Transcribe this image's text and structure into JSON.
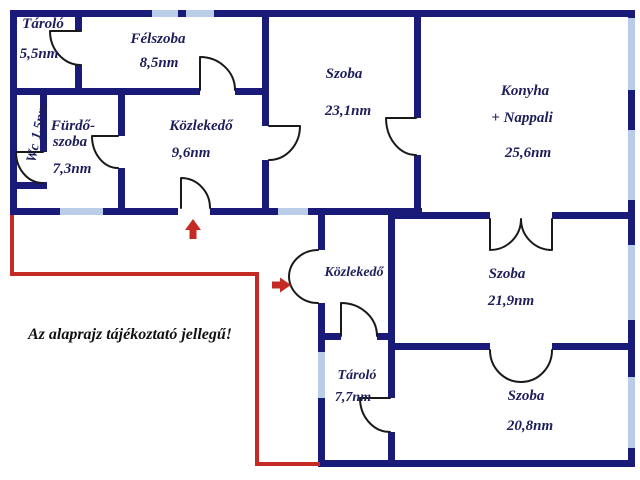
{
  "title": "Floor plan",
  "disclaimer": "Az alaprajz tájékoztató jellegű!",
  "colors": {
    "wall": "#1a1a78",
    "window": "#b9cde8",
    "door": "#1a1a1a",
    "red": "#c32b24",
    "label": "#1e1e5a",
    "ink": "#111111",
    "background": "#ffffff"
  },
  "rooms": [
    {
      "id": "tarolo-1",
      "name": "Tároló",
      "area": "5,5nm"
    },
    {
      "id": "felszoba",
      "name": "Félszoba",
      "area": "8,5nm"
    },
    {
      "id": "wc",
      "name": "Wc",
      "area": "1,5nm"
    },
    {
      "id": "furdoszoba",
      "name_line1": "Fürdő-",
      "name_line2": "szoba",
      "area": "7,3nm"
    },
    {
      "id": "kozlekedo-1",
      "name": "Közlekedő",
      "area": "9,6nm"
    },
    {
      "id": "szoba-1",
      "name": "Szoba",
      "area": "23,1nm"
    },
    {
      "id": "konyha-nappali",
      "name": "Konyha",
      "name_line2": "+ Nappali",
      "area": "25,6nm"
    },
    {
      "id": "kozlekedo-2",
      "name": "Közlekedő",
      "area": ""
    },
    {
      "id": "szoba-2",
      "name": "Szoba",
      "area": "21,9nm"
    },
    {
      "id": "tarolo-2",
      "name": "Tároló",
      "area": "7,7nm"
    },
    {
      "id": "szoba-3",
      "name": "Szoba",
      "area": "20,8nm"
    }
  ]
}
